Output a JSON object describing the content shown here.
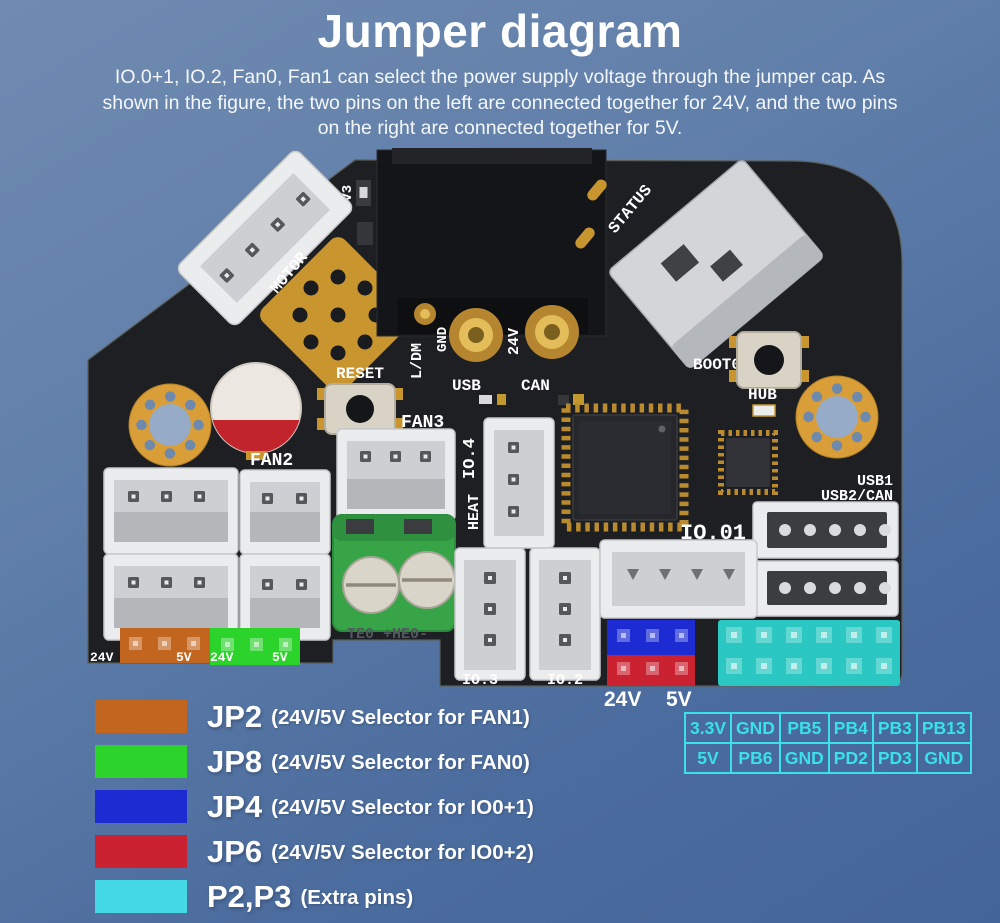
{
  "page": {
    "background_top": "#6d88ae",
    "background_bottom": "#45689b"
  },
  "header": {
    "title": "Jumper diagram",
    "description": "IO.0+1, IO.2, Fan0, Fan1 can select the power supply voltage through the jumper cap. As shown in the figure, the two pins on the left are connected together for 24V, and the two pins on the right are connected together for 5V."
  },
  "board": {
    "p2p3_color": "#2bc8c3",
    "labels": {
      "motor": "MOTOR",
      "v3v3": "3V3",
      "status": "STATUS",
      "reset": "RESET",
      "ldm": "L/DM",
      "gnd": "GND",
      "v24": "24V",
      "usb": "USB",
      "can": "CAN",
      "fan3": "FAN3",
      "fan2": "FAN2",
      "io4": "IO.4",
      "heat": "HEAT",
      "boot0": "BOOT0",
      "hub": "HUB",
      "io01": "IO.01",
      "usb1": "USB1",
      "usb2can": "USB2/CAN",
      "te_he": "TE0  +HE0-",
      "io3": "IO.3",
      "io2": "IO.2",
      "jumper_24v": "24V",
      "jumper_5v": "5V",
      "fan1_24v": "24V",
      "fan1_5v": "5V",
      "fan0_24v": "24V",
      "fan0_5v": "5V"
    }
  },
  "legend": {
    "items": [
      {
        "name": "JP2",
        "desc": "(24V/5V Selector for FAN1)",
        "color": "#c2651f"
      },
      {
        "name": "JP8",
        "desc": "(24V/5V Selector for FAN0)",
        "color": "#2bd32b"
      },
      {
        "name": "JP4",
        "desc": "(24V/5V Selector for IO0+1)",
        "color": "#1c2bd2"
      },
      {
        "name": "JP6",
        "desc": "(24V/5V Selector for IO0+2)",
        "color": "#cb2231"
      },
      {
        "name": "P2,P3",
        "desc": "(Extra pins)",
        "color": "#45d9e8"
      }
    ]
  },
  "pin_table": {
    "accent": "#3ae0ea",
    "rows": [
      [
        "3.3V",
        "GND",
        "PB5",
        "PB4",
        "PB3",
        "PB13"
      ],
      [
        "5V",
        "PB6",
        "GND",
        "PD2",
        "PD3",
        "GND"
      ]
    ]
  }
}
